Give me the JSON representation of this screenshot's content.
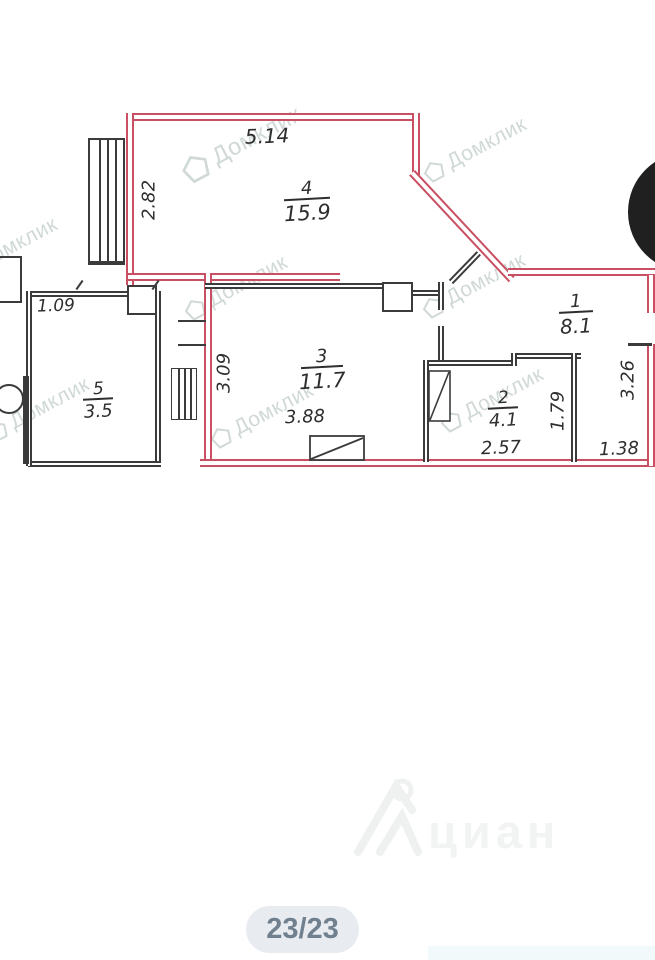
{
  "plan": {
    "rooms": {
      "r4": {
        "number": "4",
        "area": "15.9"
      },
      "r3": {
        "number": "3",
        "area": "11.7"
      },
      "r1": {
        "number": "1",
        "area": "8.1"
      },
      "r2": {
        "number": "2",
        "area": "4.1"
      },
      "r5": {
        "number": "5",
        "area": "3.5"
      }
    },
    "dimensions": {
      "room4_top": "5.14",
      "room4_left": "2.82",
      "balcony_top": "1.09",
      "room3_left": "3.09",
      "room3_bottom": "3.88",
      "room2_bottom": "2.57",
      "room2_right": "1.79",
      "room1_right": "3.26",
      "bottom_right": "1.38"
    }
  },
  "watermarks": {
    "domklik": "Домклик",
    "cian": "циан"
  },
  "pager": {
    "label": "23/23"
  },
  "colors": {
    "boundary_red": "#c94f62",
    "interior_black": "#3b3b3b",
    "badge_bg": "#e8ecf1",
    "badge_text": "#70808f"
  }
}
